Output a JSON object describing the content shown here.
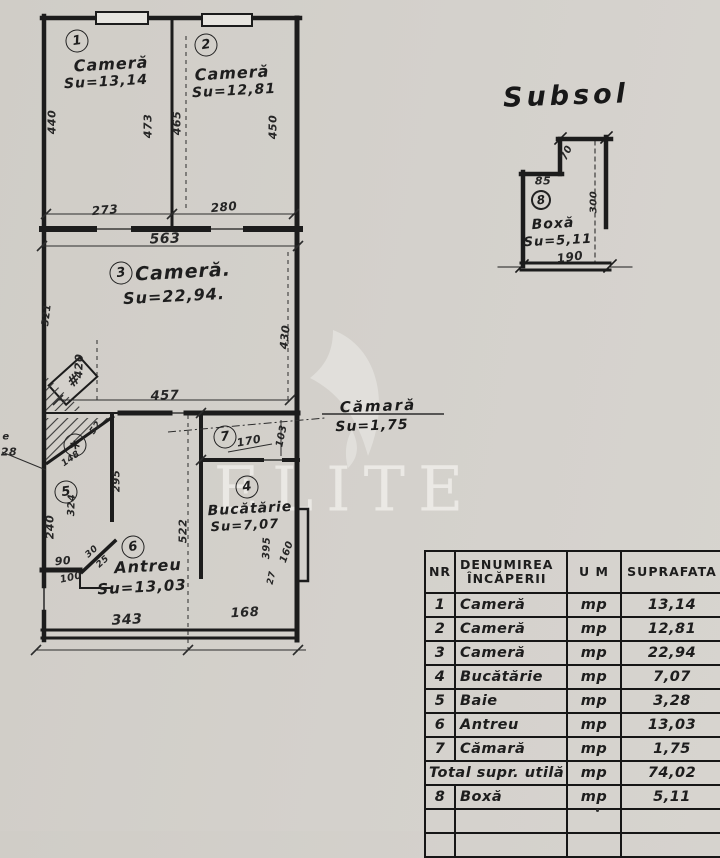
{
  "basement": {
    "title": "Subsol"
  },
  "watermark": {
    "text": "ELITE"
  },
  "plan": {
    "rooms": [
      {
        "nr": "1",
        "name": "Cameră",
        "area": "Su=13,14",
        "cx": 77,
        "cy": 41,
        "nx": 111,
        "ny": 64,
        "ax": 106,
        "ay": 82,
        "nfs": 16,
        "afs": 14
      },
      {
        "nr": "2",
        "name": "Cameră",
        "area": "Su=12,81",
        "cx": 206,
        "cy": 45,
        "nx": 232,
        "ny": 73,
        "ax": 234,
        "ay": 91,
        "nfs": 16,
        "afs": 14
      },
      {
        "nr": "3",
        "name": "Cameră.",
        "area": "Su=22,94.",
        "cx": 121,
        "cy": 273,
        "nx": 183,
        "ny": 272,
        "ax": 174,
        "ay": 296,
        "nfs": 19,
        "afs": 16
      },
      {
        "nr": "4",
        "name": "Bucătărie",
        "area": "Su=7,07",
        "cx": 247,
        "cy": 487,
        "nx": 250,
        "ny": 509,
        "ax": 245,
        "ay": 526,
        "nfs": 14,
        "afs": 13
      },
      {
        "nr": "5",
        "name": "",
        "area": "",
        "cx": 66,
        "cy": 492
      },
      {
        "nr": "6",
        "name": "Antreu",
        "area": "Su=13,03",
        "cx": 133,
        "cy": 547,
        "nx": 148,
        "ny": 566,
        "ax": 142,
        "ay": 587,
        "nfs": 16,
        "afs": 15
      },
      {
        "nr": "7",
        "name": "",
        "area": "",
        "cx": 225,
        "cy": 437
      },
      {
        "nr": "8",
        "name": "Boxă",
        "area": "Su=5,11",
        "cx": 541,
        "cy": 200,
        "nx": 553,
        "ny": 224,
        "ax": 558,
        "ay": 241,
        "nfs": 14,
        "afs": 13
      }
    ],
    "marker": {
      "symbol": "*",
      "cx": 75,
      "cy": 445
    },
    "callout": {
      "name": "Cămară",
      "area": "Su=1,75"
    },
    "dim_labels": [
      {
        "t": "440",
        "x": 52,
        "y": 122,
        "r": -90,
        "fs": 11
      },
      {
        "t": "473",
        "x": 148,
        "y": 126,
        "r": -90,
        "fs": 11
      },
      {
        "t": "465",
        "x": 177,
        "y": 123,
        "r": -90,
        "fs": 11
      },
      {
        "t": "450",
        "x": 273,
        "y": 127,
        "r": -90,
        "fs": 11
      },
      {
        "t": "273",
        "x": 105,
        "y": 210,
        "r": -5,
        "fs": 12
      },
      {
        "t": "280",
        "x": 224,
        "y": 207,
        "r": -5,
        "fs": 12
      },
      {
        "t": "563",
        "x": 165,
        "y": 239,
        "r": -2,
        "fs": 14
      },
      {
        "t": "321",
        "x": 47,
        "y": 315,
        "r": -83,
        "fs": 10
      },
      {
        "t": "420",
        "x": 79,
        "y": 366,
        "r": -88,
        "fs": 11
      },
      {
        "t": "430",
        "x": 285,
        "y": 337,
        "r": -84,
        "fs": 11
      },
      {
        "t": "457",
        "x": 165,
        "y": 396,
        "r": -2,
        "fs": 13
      },
      {
        "t": "52",
        "x": 96,
        "y": 428,
        "r": -55,
        "fs": 9
      },
      {
        "t": "148",
        "x": 71,
        "y": 459,
        "r": -35,
        "fs": 9
      },
      {
        "t": "295",
        "x": 117,
        "y": 481,
        "r": -90,
        "fs": 10
      },
      {
        "t": "324",
        "x": 72,
        "y": 505,
        "r": -88,
        "fs": 10
      },
      {
        "t": "240",
        "x": 50,
        "y": 527,
        "r": -90,
        "fs": 11
      },
      {
        "t": "90",
        "x": 63,
        "y": 561,
        "r": -5,
        "fs": 11
      },
      {
        "t": "100",
        "x": 71,
        "y": 578,
        "r": -12,
        "fs": 10
      },
      {
        "t": "30",
        "x": 92,
        "y": 552,
        "r": -42,
        "fs": 9
      },
      {
        "t": "25",
        "x": 103,
        "y": 562,
        "r": -42,
        "fs": 9
      },
      {
        "t": "522",
        "x": 183,
        "y": 531,
        "r": -90,
        "fs": 11
      },
      {
        "t": "170",
        "x": 249,
        "y": 441,
        "r": -10,
        "fs": 11
      },
      {
        "t": "103",
        "x": 282,
        "y": 436,
        "r": -78,
        "fs": 10
      },
      {
        "t": "395",
        "x": 267,
        "y": 548,
        "r": -88,
        "fs": 10
      },
      {
        "t": "160",
        "x": 287,
        "y": 552,
        "r": -70,
        "fs": 10
      },
      {
        "t": "27",
        "x": 272,
        "y": 578,
        "r": -78,
        "fs": 9
      },
      {
        "t": "343",
        "x": 127,
        "y": 620,
        "r": -3,
        "fs": 14
      },
      {
        "t": "168",
        "x": 245,
        "y": 613,
        "r": -3,
        "fs": 13
      },
      {
        "t": "#",
        "x": 73,
        "y": 381,
        "r": -42,
        "fs": 15
      },
      {
        "t": "e",
        "x": 6,
        "y": 437,
        "r": 0,
        "fs": 10
      },
      {
        "t": "28",
        "x": 9,
        "y": 452,
        "r": 0,
        "fs": 11
      },
      {
        "t": "85",
        "x": 543,
        "y": 181,
        "r": 0,
        "fs": 11
      },
      {
        "t": "70",
        "x": 567,
        "y": 153,
        "r": -65,
        "fs": 10
      },
      {
        "t": "300",
        "x": 594,
        "y": 202,
        "r": -90,
        "fs": 10
      },
      {
        "t": "190",
        "x": 570,
        "y": 257,
        "r": -8,
        "fs": 12
      }
    ]
  },
  "table": {
    "headers": [
      "NR",
      "DENUMIREA\nÎNCĂPERII",
      "U M",
      "SUPRAFATA"
    ],
    "rows": [
      {
        "nr": "1",
        "name": "Cameră",
        "um": "mp",
        "value": "13,14"
      },
      {
        "nr": "2",
        "name": "Cameră",
        "um": "mp",
        "value": "12,81"
      },
      {
        "nr": "3",
        "name": "Cameră",
        "um": "mp",
        "value": "22,94"
      },
      {
        "nr": "4",
        "name": "Bucătărie",
        "um": "mp",
        "value": "7,07"
      },
      {
        "nr": "5",
        "name": "Baie",
        "um": "mp",
        "value": "3,28"
      },
      {
        "nr": "6",
        "name": "Antreu",
        "um": "mp",
        "value": "13,03"
      },
      {
        "nr": "7",
        "name": "Cămară",
        "um": "mp",
        "value": "1,75"
      },
      {
        "nr": "",
        "name": "Total supr. utilă",
        "um": "mp",
        "value": "74,02",
        "merged": true
      },
      {
        "nr": "8",
        "name": "Boxă",
        "um": "mp",
        "value": "5,11"
      },
      {
        "nr": "",
        "name": "",
        "um": "",
        "value": ""
      },
      {
        "nr": "",
        "name": "",
        "um": "",
        "value": ""
      }
    ]
  }
}
